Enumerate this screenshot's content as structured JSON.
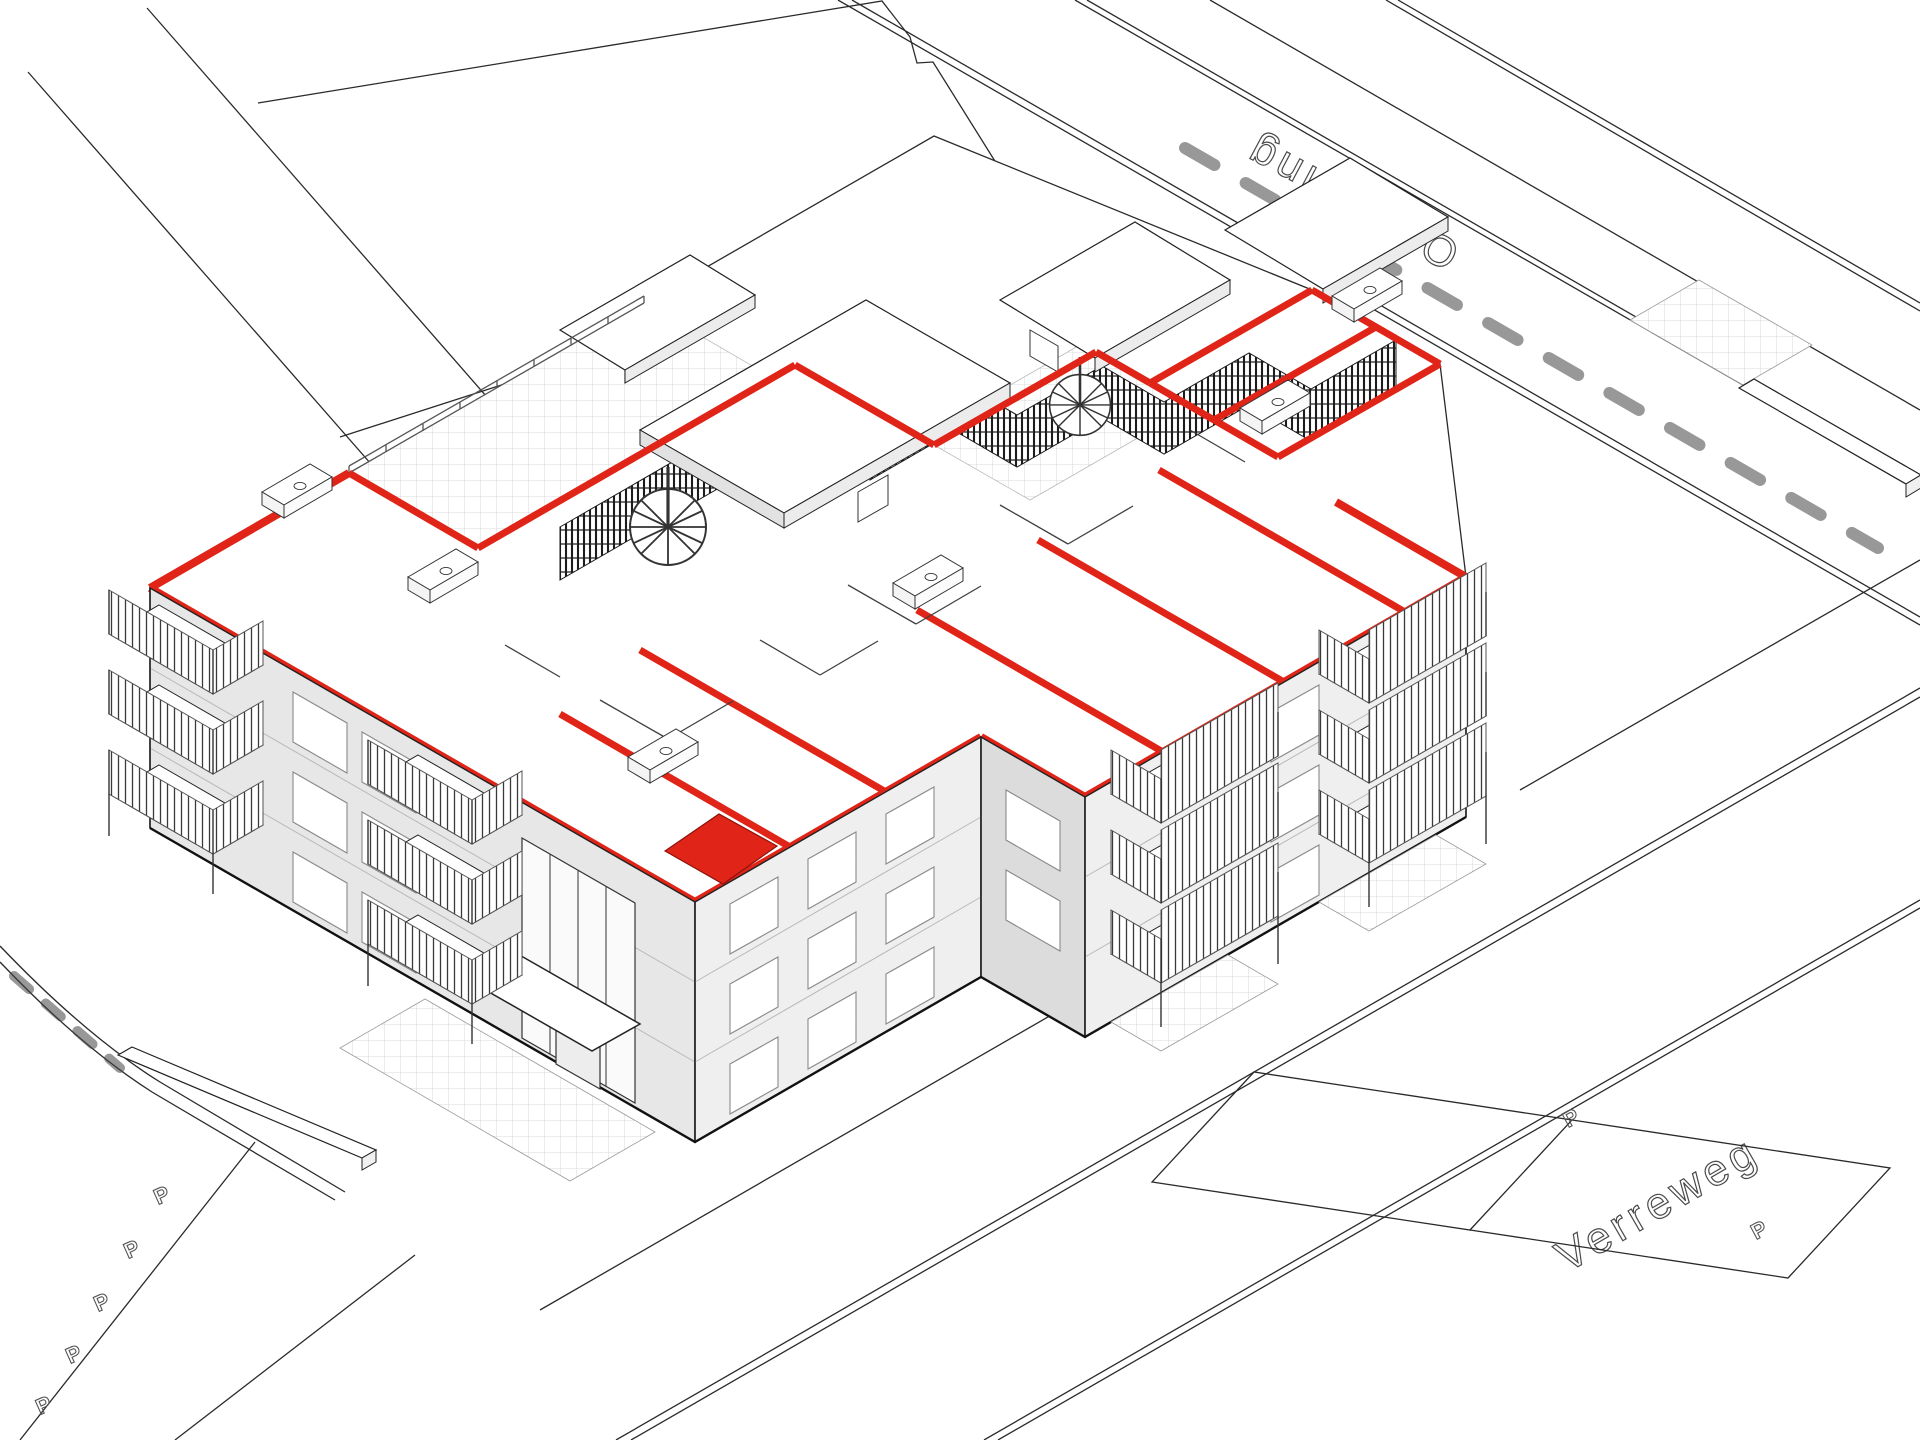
{
  "diagram": {
    "type": "axonometric-site-cutaway",
    "description": "3D axonometric cutaway drawing of an apartment block; top-floor section cut shown with red walls and one room highlighted in solid red; surrounding streets, parking bays and neighbouring plots drawn in thin black line work",
    "streets": [
      {
        "name": "Onderling",
        "position": "upper-right road",
        "label_rotation_deg": 208
      },
      {
        "name": "Verreweg",
        "position": "lower-right road",
        "label_rotation_deg": -30
      }
    ],
    "parking": {
      "symbol": "P",
      "markers_left": 5,
      "markers_right": 3
    },
    "building": {
      "storeys_below_cut": 3,
      "cut_level": "top floor plan exposed",
      "features": [
        "red section-cut walls",
        "solid red highlighted room",
        "roof terraces with dark louvre screens",
        "spiral staircases on roof terraces",
        "slatted balcony railings",
        "glazed entrance with canopy",
        "kitchen counters visible in plan"
      ]
    },
    "colors": {
      "cut_red": "#e02417",
      "dark_red_edge": "#7e120b",
      "facade_grey": "#ededed",
      "line_black": "#2a2a2a",
      "screen_dark": "#1c1c1c",
      "pavement_grid": "#cfcfcf",
      "background": "#ffffff"
    }
  }
}
